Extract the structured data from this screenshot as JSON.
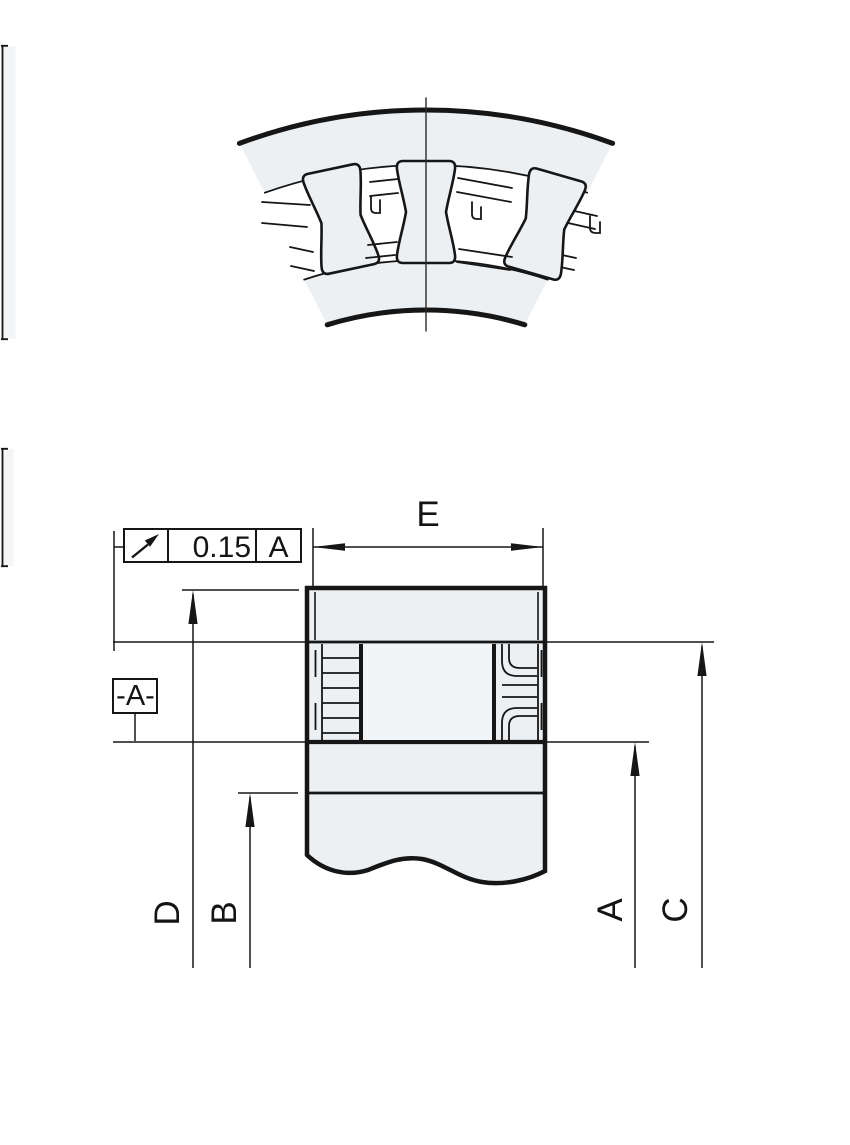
{
  "labels": {
    "e": "E",
    "d": "D",
    "b": "B",
    "a": "A",
    "c": "C"
  },
  "fcf": {
    "symbol_icon": "circular-runout-icon",
    "tolerance": "0.15",
    "datum_ref": "A"
  },
  "datum_flag": {
    "label": "-A-"
  },
  "colors": {
    "line": "#161616",
    "fill_light": "#edf0f3",
    "background": "#ffffff"
  }
}
